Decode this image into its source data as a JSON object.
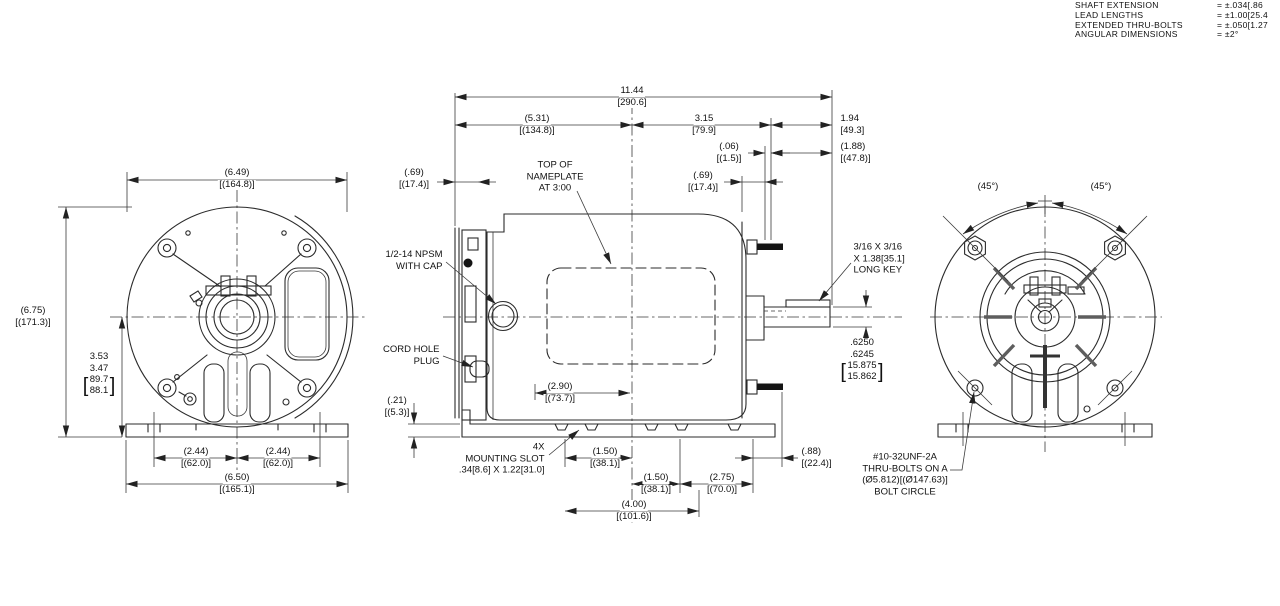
{
  "tolerance_block": {
    "rows": [
      {
        "label": "SHAFT EXTENSION",
        "value": "= ±.034[.86"
      },
      {
        "label": "LEAD LENGTHS",
        "value": "= ±1.00[25.4"
      },
      {
        "label": "EXTENDED THRU-BOLTS",
        "value": "= ±.050[1.27"
      },
      {
        "label": "ANGULAR DIMENSIONS",
        "value": "= ±2°"
      }
    ]
  },
  "side_view": {
    "dims": {
      "overall_length": {
        "in": "11.44",
        "mm": "[290.6]"
      },
      "front_to_center": {
        "in": "(5.31)",
        "mm": "[(134.8)]"
      },
      "center_to_rear": {
        "in": "3.15",
        "mm": "[79.9]"
      },
      "shaft_extension": {
        "in": "1.94",
        "mm": "[49.3]"
      },
      "bolt_clearance": {
        "in": "(.06)",
        "mm": "[(1.5)]"
      },
      "shaft_extension_ref": {
        "in": "(1.88)",
        "mm": "[(47.8)]"
      },
      "rear_face_offset": {
        "in": "(.69)",
        "mm": "[(17.4)]"
      },
      "front_face_offset": {
        "in": "(.69)",
        "mm": "[(17.4)]"
      },
      "base_thickness": {
        "in": "(.21)",
        "mm": "[(5.3)]"
      },
      "nameplate_offset": {
        "in": "(2.90)",
        "mm": "[(73.7)]"
      },
      "slot_spacing_front": {
        "in": "(1.50)",
        "mm": "[(38.1)]"
      },
      "slot_spacing_rear": {
        "in": "(1.50)",
        "mm": "[(38.1)]"
      },
      "rear_foot_offset": {
        "in": "(2.75)",
        "mm": "[(70.0)]"
      },
      "rear_overhang": {
        "in": "(.88)",
        "mm": "[(22.4)]"
      },
      "slot_span": {
        "in": "(4.00)",
        "mm": "[(101.6)]"
      },
      "shaft_dia": {
        "in1": ".6250",
        "in2": ".6245",
        "mm1": "15.875",
        "mm2": "15.862"
      }
    },
    "callouts": {
      "nameplate": {
        "l1": "TOP OF",
        "l2": "NAMEPLATE",
        "l3": "AT 3:00"
      },
      "npsm": {
        "l1": "1/2-14 NPSM",
        "l2": "WITH CAP"
      },
      "cord_plug": {
        "l1": "CORD HOLE",
        "l2": "PLUG"
      },
      "mounting_slot": {
        "l1": "4X",
        "l2": "MOUNTING SLOT",
        "l3": ".34[8.6] X 1.22[31.0]"
      },
      "key": {
        "l1": "3/16 X 3/16",
        "l2": "X 1.38[35.1]",
        "l3": "LONG KEY"
      }
    }
  },
  "front_view": {
    "dims": {
      "width": {
        "in": "(6.49)",
        "mm": "[(164.8)]"
      },
      "height": {
        "in": "(6.75)",
        "mm": "[(171.3)]"
      },
      "shaft_height": {
        "in1": "3.53",
        "in2": "3.47",
        "mm1": "89.7",
        "mm2": "88.1"
      },
      "foot_left": {
        "in": "(2.44)",
        "mm": "[(62.0)]"
      },
      "foot_right": {
        "in": "(2.44)",
        "mm": "[(62.0)]"
      },
      "base_width": {
        "in": "(6.50)",
        "mm": "[(165.1)]"
      }
    }
  },
  "rear_view": {
    "dims": {
      "angle_left": "(45°)",
      "angle_right": "(45°)"
    },
    "callouts": {
      "thru_bolts": {
        "l1": "#10-32UNF-2A",
        "l2": "THRU-BOLTS ON A",
        "l3": "(Ø5.812)[(Ø147.63)]",
        "l4": "BOLT CIRCLE"
      }
    }
  },
  "colors": {
    "line": "#2b2b2b",
    "background": "#ffffff"
  }
}
